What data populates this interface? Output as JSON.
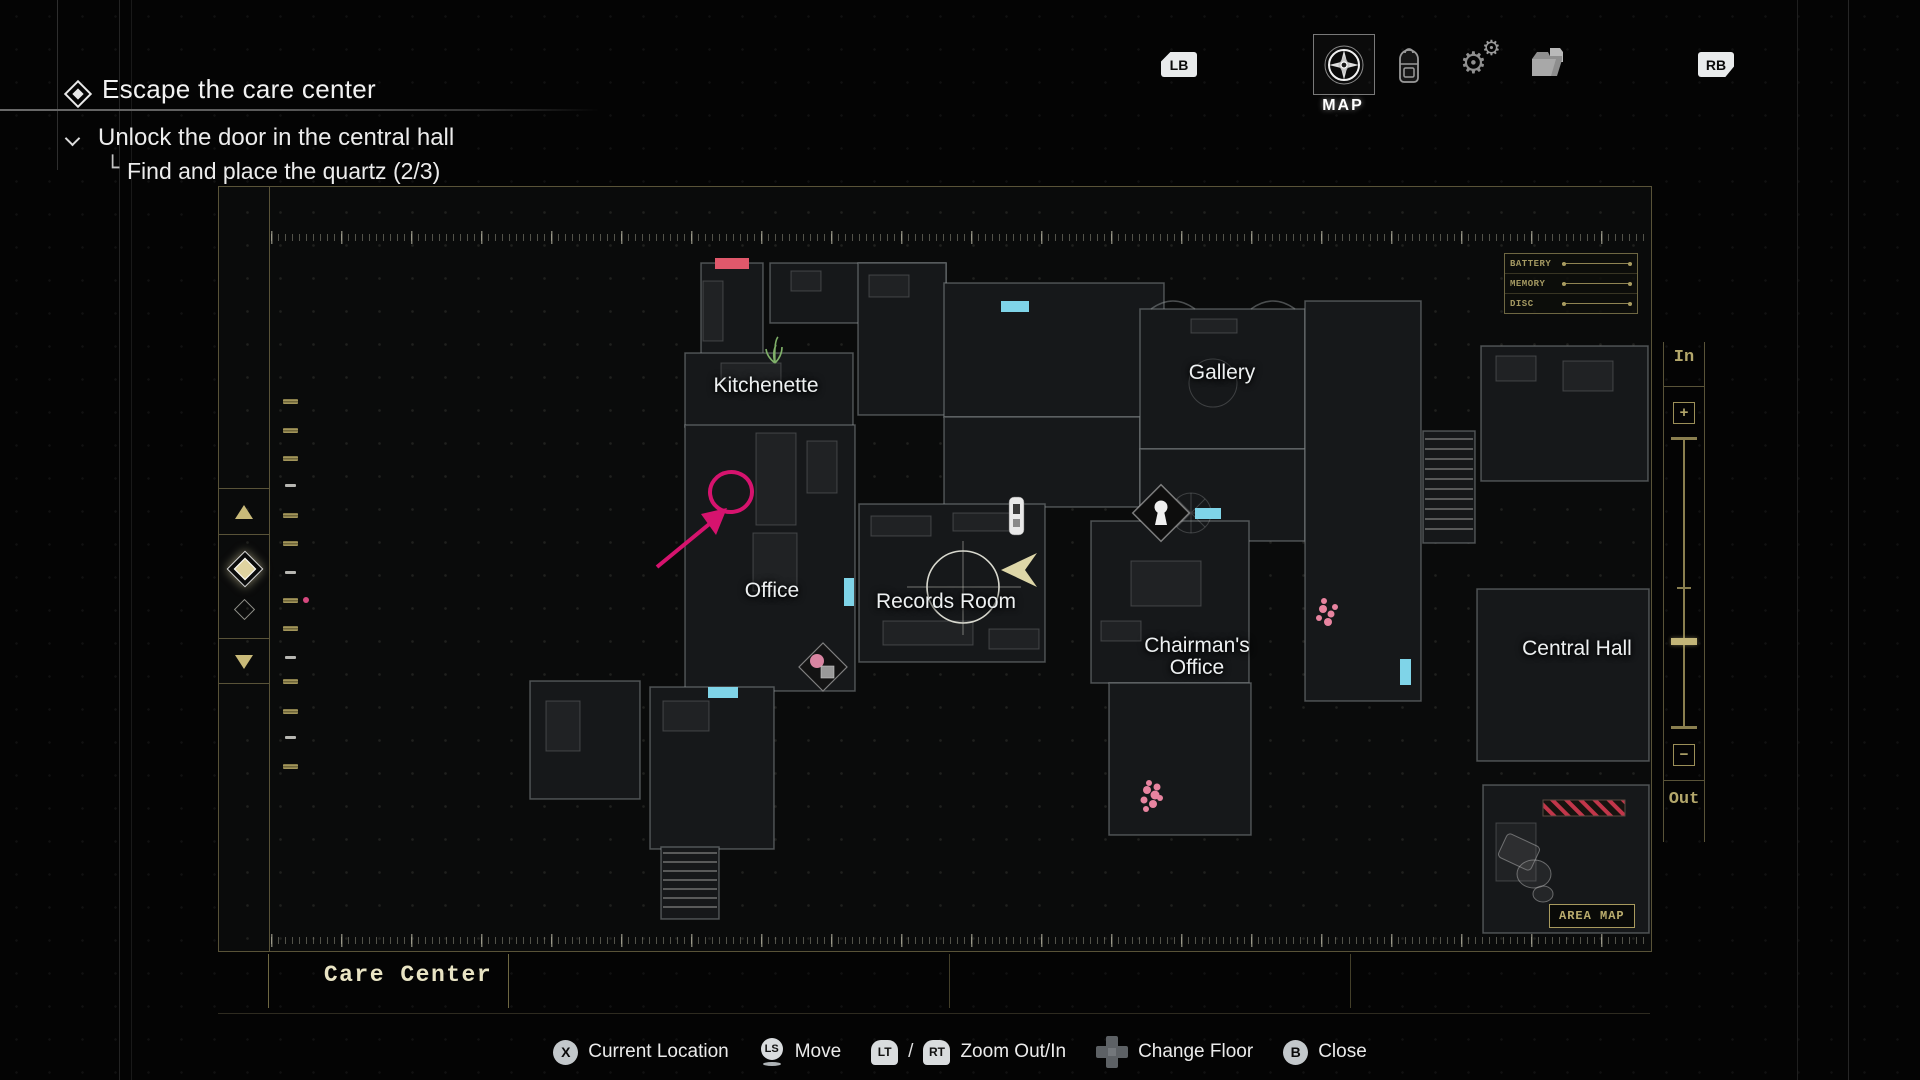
{
  "colors": {
    "gold_accent": "#b3a76b",
    "gold_frame": "#595338",
    "cyan_door": "#7fd4e8",
    "red_door": "#e0586b",
    "magenta_annotation": "#d6136e",
    "player_arrow": "#ddd6a8",
    "pink_cluster": "#e884a0",
    "text": "#f0f0f0"
  },
  "objectives": {
    "title": "Escape the care center",
    "objective": "Unlock the door in the central hall",
    "sub_objective_prefix": "└",
    "sub_objective": "Find and place the quartz (2/3)"
  },
  "tab_bar": {
    "lb": "LB",
    "rb": "RB",
    "active_tab_label": "MAP",
    "tabs": [
      "map",
      "inventory",
      "crafting",
      "files"
    ]
  },
  "map_panel": {
    "rooms": [
      {
        "name": "Kitchenette"
      },
      {
        "name": "Gallery"
      },
      {
        "name": "Office"
      },
      {
        "name": "Records Room"
      },
      {
        "name": "Chairman's Office"
      },
      {
        "name": "Central Hall"
      }
    ],
    "status_panel": [
      "BATTERY",
      "MEMORY",
      "DISC"
    ],
    "area_map_badge": "AREA MAP",
    "zoom_control": {
      "in": "In",
      "out": "Out",
      "plus": "+",
      "minus": "−"
    },
    "area_name": "Care Center"
  },
  "hint_bar": [
    {
      "button": "X",
      "label": "Current Location"
    },
    {
      "button": "LS",
      "label": "Move"
    },
    {
      "button": "LT",
      "separator": "/",
      "button2": "RT",
      "label": "Zoom Out/In"
    },
    {
      "button": "dpad",
      "label": "Change Floor"
    },
    {
      "button": "B",
      "label": "Close"
    }
  ]
}
